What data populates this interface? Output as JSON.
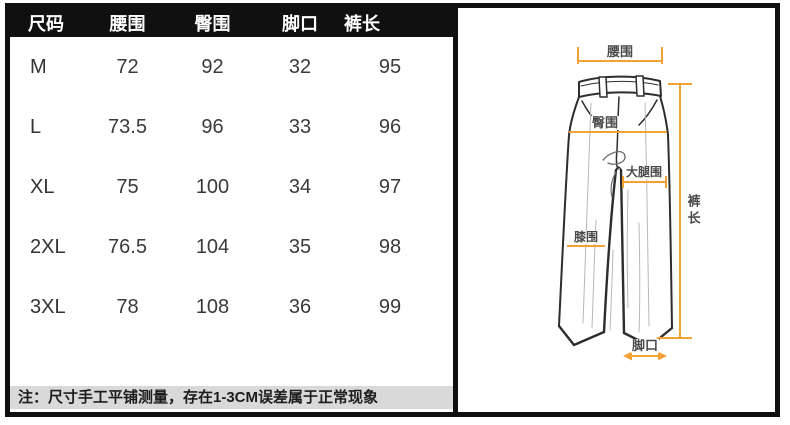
{
  "size_chart": {
    "headers": {
      "size": "尺码",
      "waist": "腰围",
      "hip": "臀围",
      "leg_opening": "脚口",
      "length": "裤长"
    },
    "rows": [
      {
        "size": "M",
        "waist": "72",
        "hip": "92",
        "leg_opening": "32",
        "length": "95"
      },
      {
        "size": "L",
        "waist": "73.5",
        "hip": "96",
        "leg_opening": "33",
        "length": "96"
      },
      {
        "size": "XL",
        "waist": "75",
        "hip": "100",
        "leg_opening": "34",
        "length": "97"
      },
      {
        "size": "2XL",
        "waist": "76.5",
        "hip": "104",
        "leg_opening": "35",
        "length": "98"
      },
      {
        "size": "3XL",
        "waist": "78",
        "hip": "108",
        "leg_opening": "36",
        "length": "99"
      }
    ],
    "note": "注：尺寸手工平铺测量，存在1-3CM误差属于正常现象"
  },
  "diagram": {
    "labels": {
      "waist": "腰围",
      "hip": "臀围",
      "thigh": "大腿围",
      "knee": "膝围",
      "length": "裤长",
      "leg_opening": "脚口"
    },
    "annotation_color": "#F0A236"
  },
  "chart_data": {
    "type": "table",
    "title": "尺码表",
    "columns": [
      "尺码",
      "腰围",
      "臀围",
      "脚口",
      "裤长"
    ],
    "rows": [
      [
        "M",
        72,
        92,
        32,
        95
      ],
      [
        "L",
        73.5,
        96,
        33,
        96
      ],
      [
        "XL",
        75,
        100,
        34,
        97
      ],
      [
        "2XL",
        76.5,
        104,
        35,
        98
      ],
      [
        "3XL",
        78,
        108,
        36,
        99
      ]
    ]
  }
}
